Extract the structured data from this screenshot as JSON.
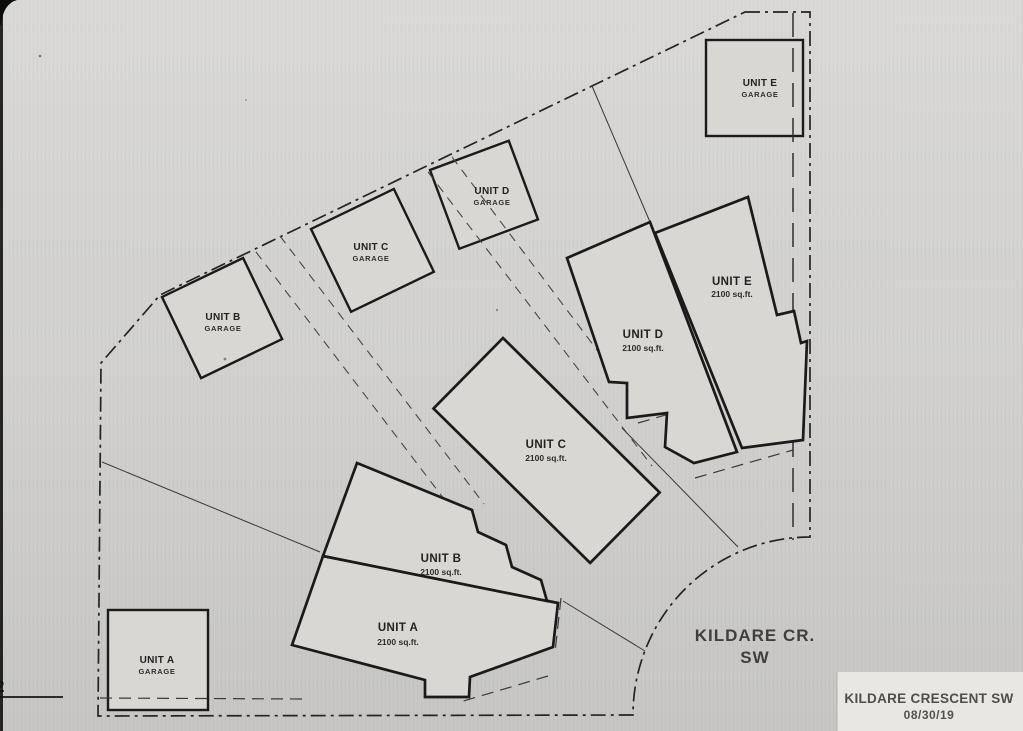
{
  "plan": {
    "street_label": {
      "line1": "KILDARE CR.",
      "line2": "SW"
    },
    "title_block": {
      "title": "KILDARE CRESCENT SW",
      "date": "08/30/19"
    },
    "page_number": "2",
    "units": [
      {
        "name": "UNIT A",
        "area": "2100 sq.ft."
      },
      {
        "name": "UNIT B",
        "area": "2100 sq.ft."
      },
      {
        "name": "UNIT C",
        "area": "2100 sq.ft."
      },
      {
        "name": "UNIT D",
        "area": "2100 sq.ft."
      },
      {
        "name": "UNIT E",
        "area": "2100 sq.ft."
      }
    ],
    "garages": [
      {
        "name": "UNIT A",
        "type": "GARAGE"
      },
      {
        "name": "UNIT B",
        "type": "GARAGE"
      },
      {
        "name": "UNIT C",
        "type": "GARAGE"
      },
      {
        "name": "UNIT D",
        "type": "GARAGE"
      },
      {
        "name": "UNIT E",
        "type": "GARAGE"
      }
    ],
    "colors": {
      "paper_top": "#dad9d7",
      "paper_bottom": "#c7c6c4",
      "ink": "#1a1a1a",
      "muted_ink": "#4a4a4a",
      "title_paper": "#e9e7e3"
    }
  }
}
